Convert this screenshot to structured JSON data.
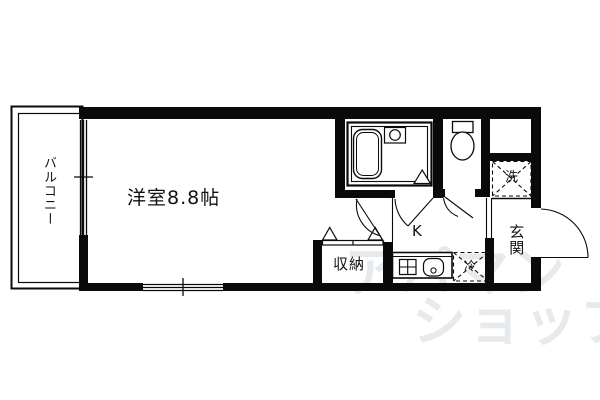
{
  "floorplan": {
    "labels": {
      "balcony": "バルコニー",
      "room": "洋室8.8帖",
      "closet": "収納",
      "kitchen": "K",
      "fridge": "冷",
      "washer": "洗",
      "entrance": "玄関"
    },
    "watermark": {
      "line1": "アパマン",
      "line2": "ショップ",
      "color": "#e6eaec"
    },
    "colors": {
      "line": "#0a0a0a",
      "background": "#ffffff"
    }
  }
}
